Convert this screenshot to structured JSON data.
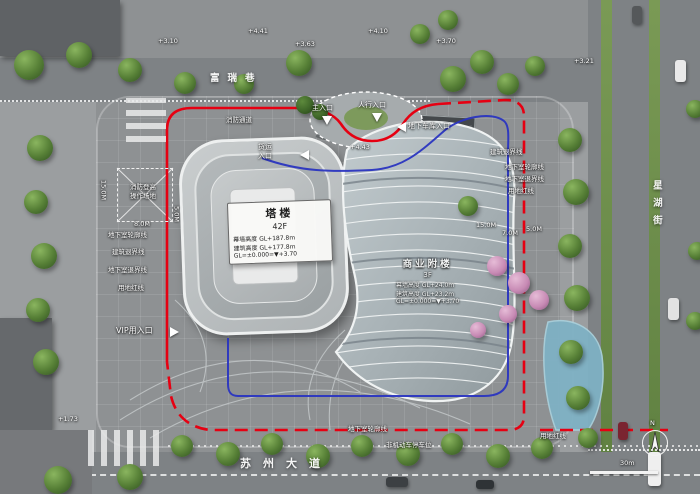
{
  "streets": {
    "top": "富瑞巷",
    "bottom": "苏州大道",
    "right": "星湖街"
  },
  "tower_card": {
    "title": "塔楼",
    "floors": "42F",
    "curtain_height": "幕墙高度 GL+187.8m",
    "building_height": "建筑高度 GL+177.8m",
    "datum": "GL=±0.000=▼+3.70"
  },
  "annex_card": {
    "title": "商业附楼",
    "floors": "3F",
    "curtain_height": "幕墙高度 GL+24.0m",
    "building_height": "建筑高度 GL+23.2m",
    "datum": "GL=±0.000=▼+3.70"
  },
  "entrances": {
    "main": "主入口",
    "pedestrian": "人行入口",
    "garage": "地下车库入口",
    "freight_top": "货运",
    "freight_bottom": "入口",
    "vip": "VIP用入口"
  },
  "setback_labels": {
    "left": [
      "地下室轮廓线",
      "建筑退界线",
      "地下室退界线",
      "用地红线"
    ],
    "right": [
      "建筑退界线",
      "地下室轮廓线",
      "地下室退界线",
      "用地红线"
    ],
    "bottom": [
      "地下室轮廓线",
      "用地红线"
    ]
  },
  "bike_parking": "非机动车停车位",
  "fire": {
    "lane": "消防通道",
    "area_line1": "消防登高",
    "area_line2": "操作场地"
  },
  "dims": {
    "fire_width": "8.0M",
    "fire_height": "15.0M",
    "side_gap": "5.0M",
    "right_a": "15.0M",
    "right_b": "7.0M",
    "right_c": "5.0M"
  },
  "elevations": [
    "+4.41",
    "+3.63",
    "+4.10",
    "+3.10",
    "+3.70",
    "+1.73",
    "+3.21",
    "+4.43"
  ],
  "compass": {
    "north": "N"
  },
  "scale": {
    "label": "30m"
  },
  "colors": {
    "red_line": "#e60012",
    "blue_line": "#2a35c0",
    "water": "#7fb1c4",
    "tree_green": "#567f36",
    "tree_pink": "#c78ab4"
  }
}
